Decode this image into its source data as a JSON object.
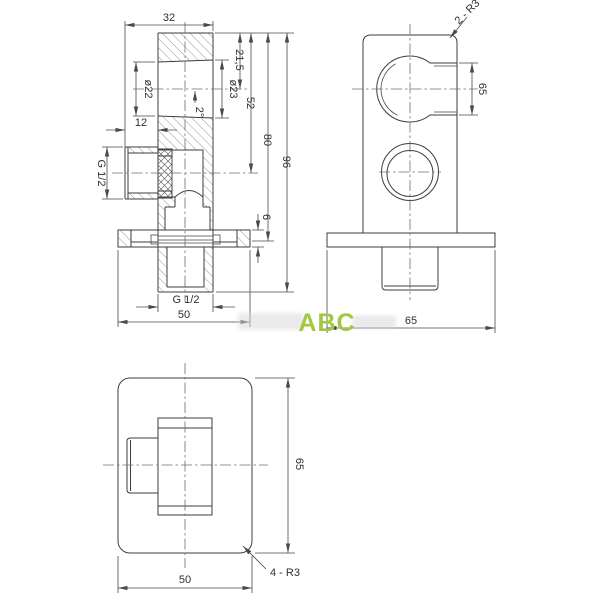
{
  "watermark": {
    "brand": "ABC",
    "brand_color": "#a2c741"
  },
  "section": {
    "dim_width": "32",
    "dim_offset": "12",
    "dim_bore_left": "ø22",
    "dim_bore_right": "ø23",
    "dim_taper": "2°",
    "dim_top_to_axis": "21,5",
    "dim_top_to_side_axis": "52",
    "dim_top_to_flange": "80",
    "dim_total": "96",
    "dim_side_thread": "G 1/2",
    "dim_bottom_thread": "G 1/2",
    "dim_flange_thickness": "6",
    "dim_flange_width": "50"
  },
  "front": {
    "dim_corner_radius": "2 - R3",
    "dim_knob_height": "65",
    "dim_flange_width": "65"
  },
  "plan": {
    "dim_height": "65",
    "dim_width": "50",
    "dim_corner_radius": "4 - R3"
  }
}
